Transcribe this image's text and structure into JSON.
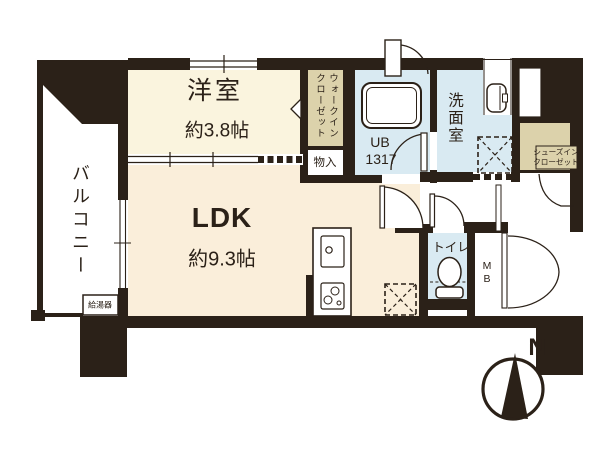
{
  "palette": {
    "wall_black": "#2b2118",
    "western_room_fill": "#faf4de",
    "ldk_fill": "#faeeda",
    "closet_beige": "#dcd2ab",
    "wet_area_blue": "#d9eaf2",
    "white": "#ffffff"
  },
  "labels": {
    "balcony": "バルコニー",
    "water_heater": "給湯器",
    "western_room_name": "洋室",
    "western_room_size": "約3.8帖",
    "ldk_name": "LDK",
    "ldk_size": "約9.3帖",
    "walkin_closet_line1": "ウォークイン",
    "walkin_closet_line2": "クローゼット",
    "storage": "物入",
    "unit_bath_name": "UB",
    "unit_bath_size": "1317",
    "washroom": "洗面室",
    "shoes_closet_line1": "シューズイン",
    "shoes_closet_line2": "クローゼット",
    "entrance": "玄関",
    "toilet": "トイレ",
    "meter_box_line1": "M",
    "meter_box_line2": "B",
    "compass_north": "N"
  }
}
